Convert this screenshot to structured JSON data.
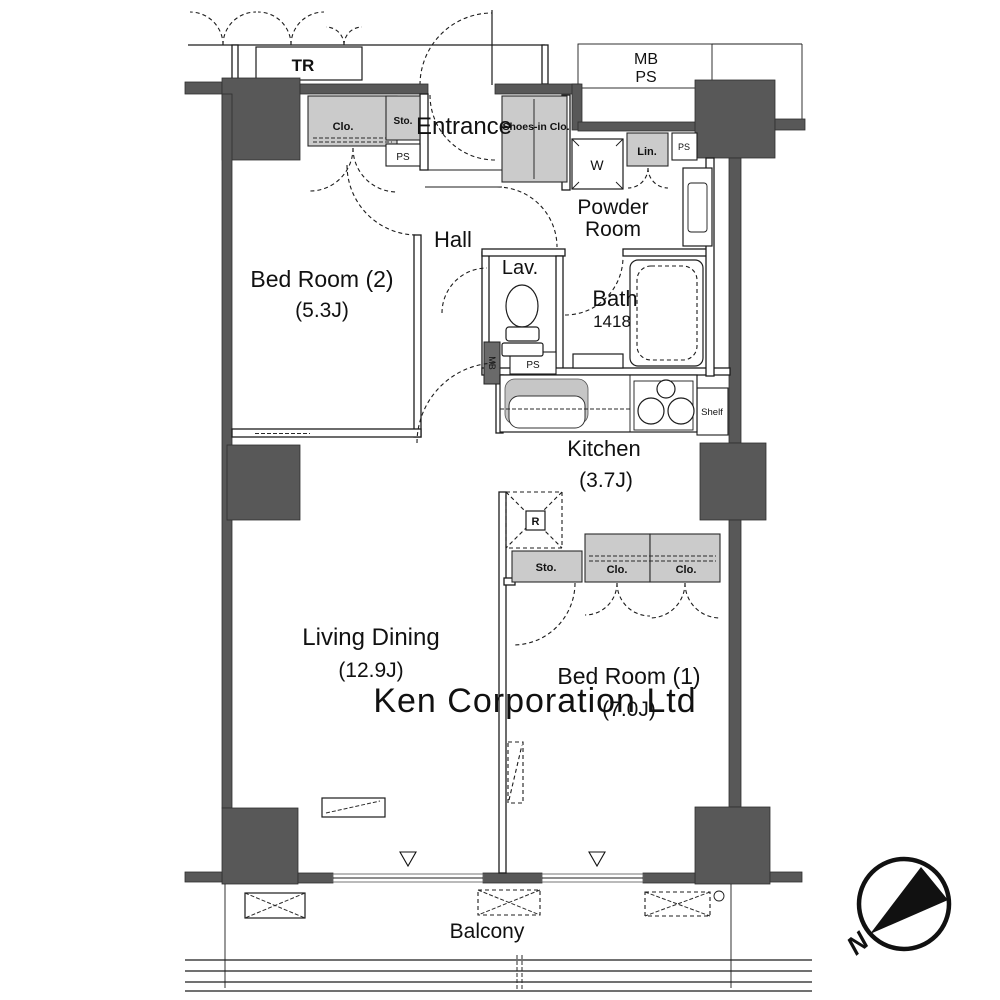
{
  "floorplan": {
    "rooms": {
      "bedroom2": {
        "label": "Bed Room (2)",
        "size": "(5.3J)"
      },
      "bedroom1": {
        "label": "Bed Room (1)",
        "size": "(7.0J)"
      },
      "living_dining": {
        "label": "Living Dining",
        "size": "(12.9J)"
      },
      "kitchen": {
        "label": "Kitchen",
        "size": "(3.7J)"
      },
      "bath": {
        "label": "Bath",
        "size": "1418"
      },
      "lavatory": {
        "label": "Lav."
      },
      "powder_room": {
        "line1": "Powder",
        "line2": "Room"
      },
      "hall": {
        "label": "Hall"
      },
      "entrance": {
        "label": "Entrance"
      },
      "balcony": {
        "label": "Balcony"
      },
      "trunk_room": {
        "label": "TR"
      },
      "meter_shaft": {
        "line1": "MB",
        "line2": "PS"
      }
    },
    "features": {
      "closet_bedroom2": "Clo.",
      "storage_top": "Sto.",
      "pipe_space_top": "PS",
      "shoes_in_closet": "Shoes-in Clo.",
      "washer": "W",
      "linen": "Lin.",
      "pipe_space_linen": "PS",
      "meter_box_small": "MB",
      "pipe_space_lav": "PS",
      "shelf": "Shelf",
      "refrigerator": "R",
      "storage_bedroom1": "Sto.",
      "closet1_bedroom1": "Clo.",
      "closet2_bedroom1": "Clo."
    },
    "compass": {
      "north": "N"
    },
    "watermark": "Ken Corporation Ltd",
    "colors": {
      "wall": "#585858",
      "closet_fill": "#cbcbcb",
      "line": "#1a1a1a",
      "watermark": "#c9c9c9"
    }
  }
}
